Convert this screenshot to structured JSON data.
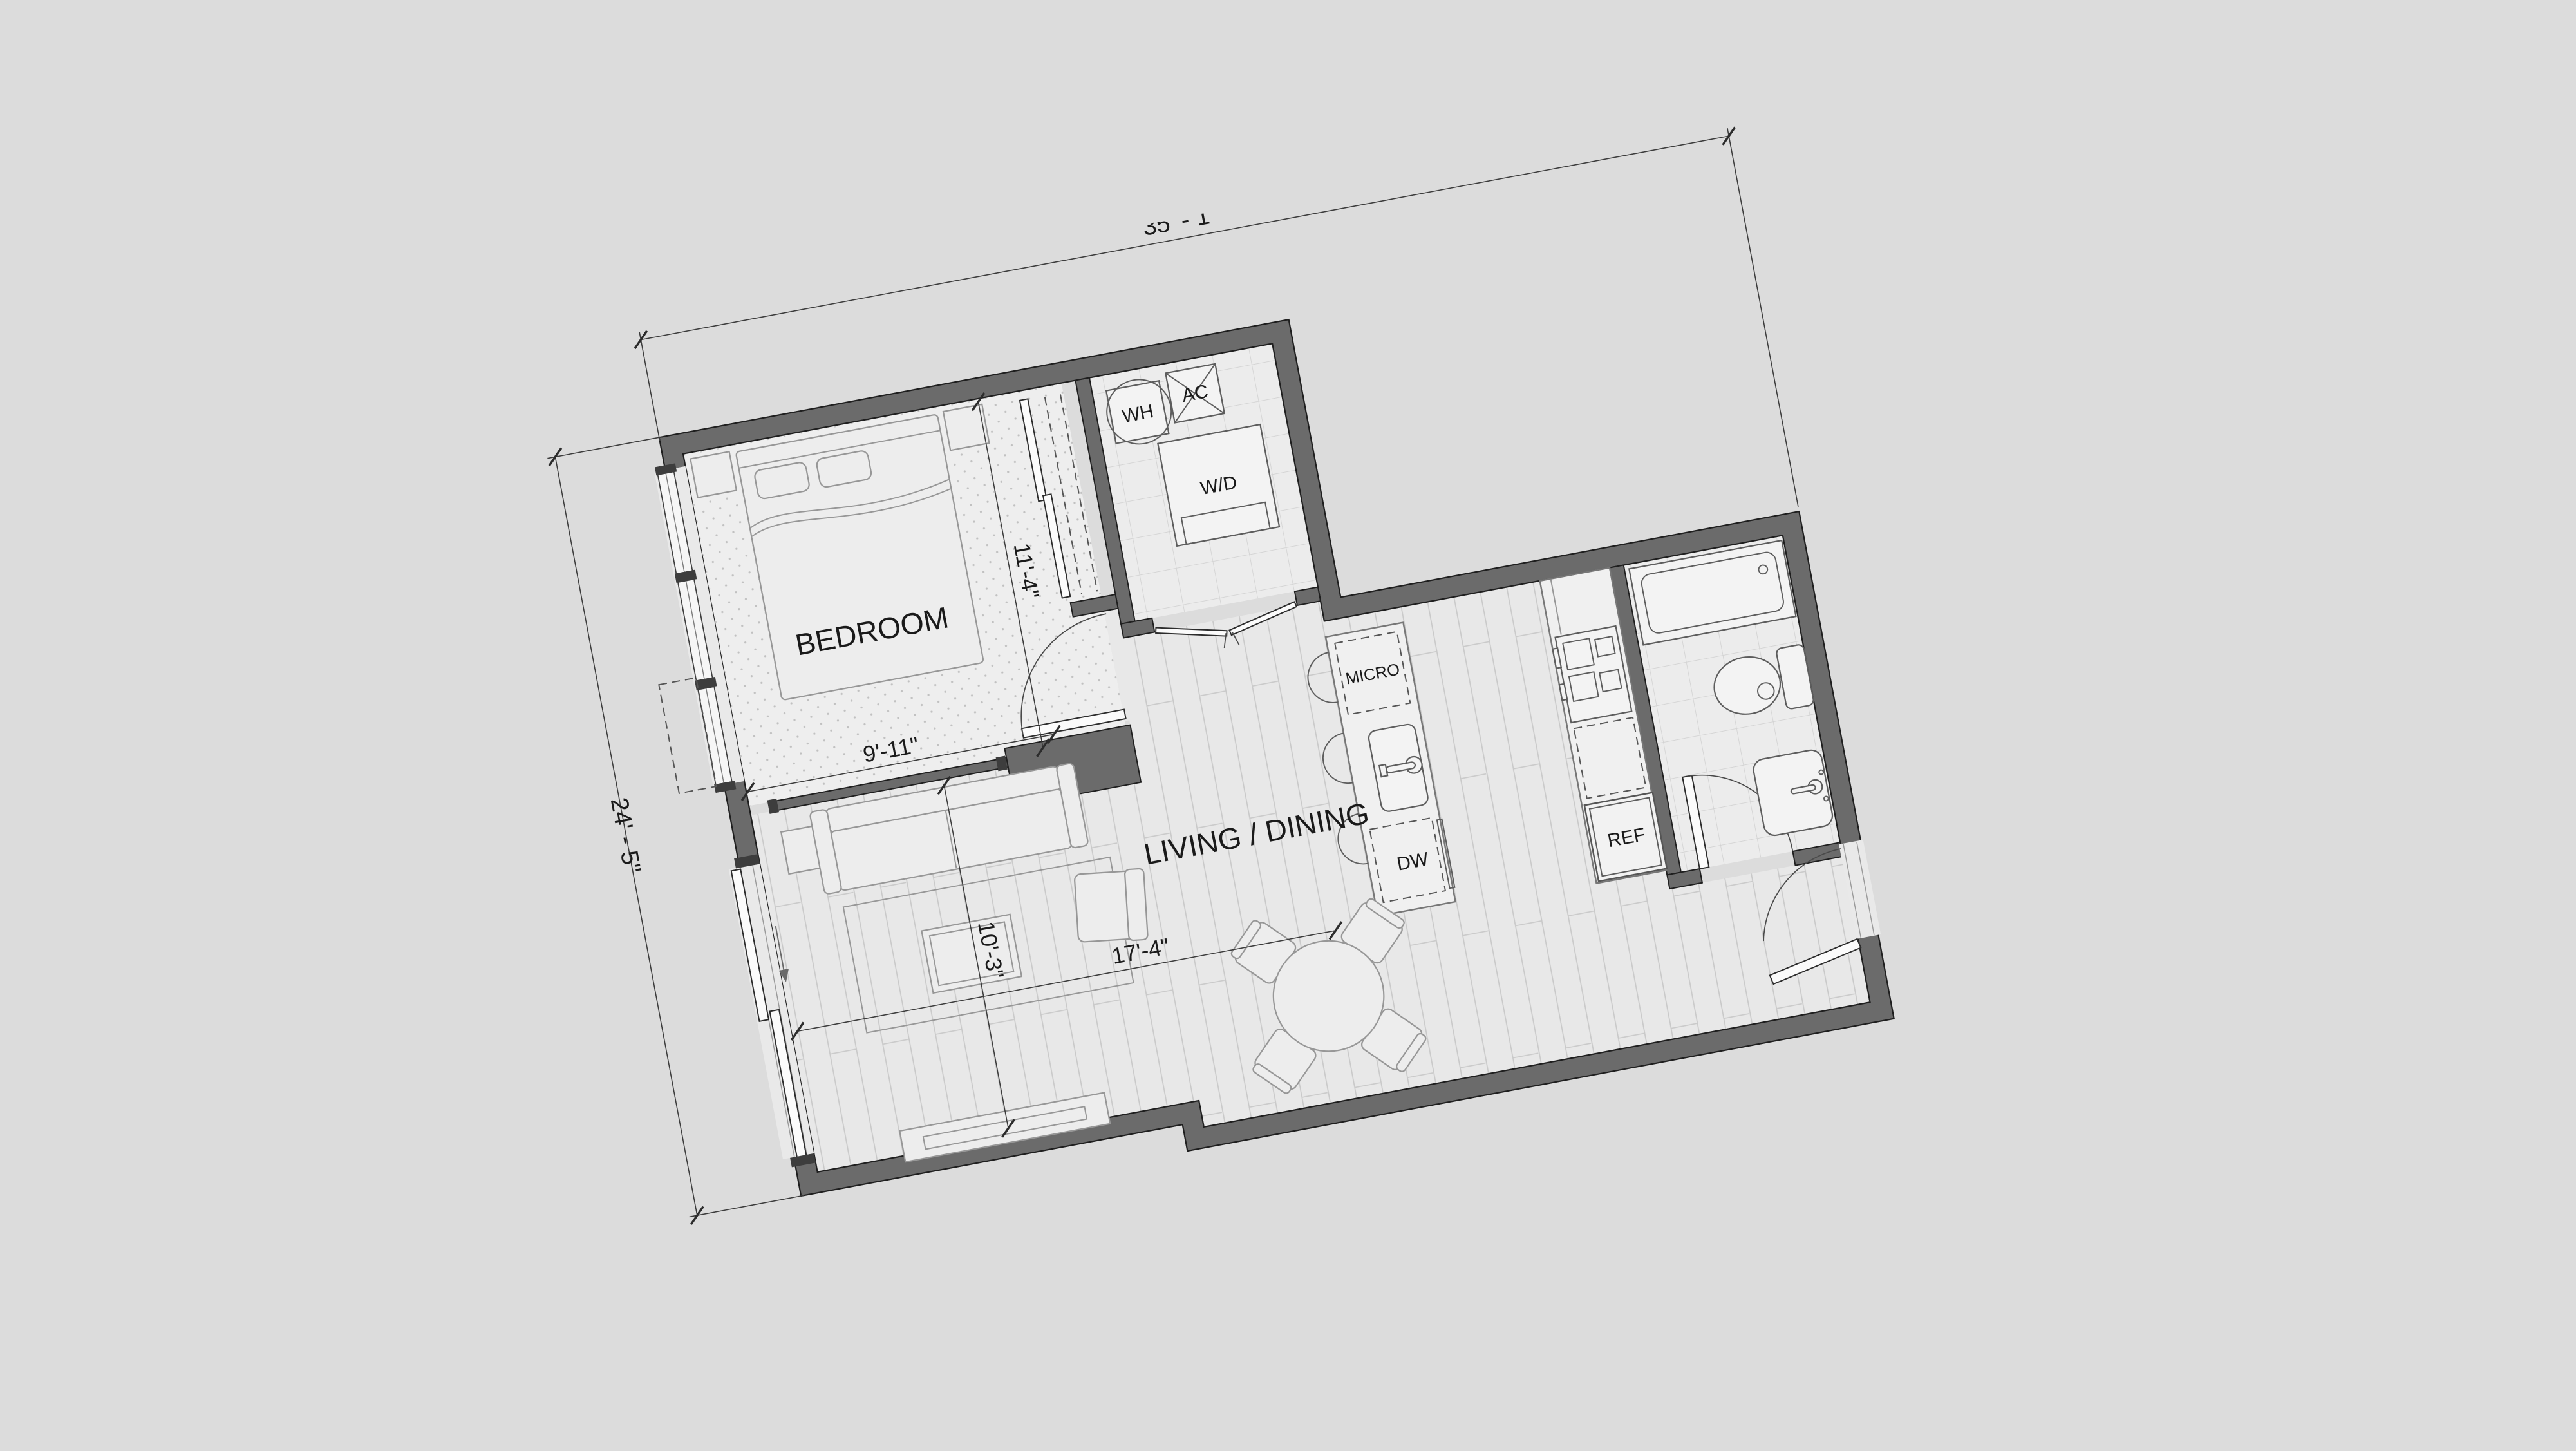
{
  "plan": {
    "type": "apartment-floor-plan",
    "background_color": "#dcdcdc",
    "wall_color": "#6b6b6b",
    "floor_color": "#e9e9e9",
    "rooms": {
      "bedroom": "BEDROOM",
      "living_dining": "LIVING / DINING"
    },
    "fixtures": {
      "water_heater": "WH",
      "air_conditioner": "AC",
      "washer_dryer": "W/D",
      "microwave": "MICRO",
      "dishwasher": "DW",
      "refrigerator": "REF"
    },
    "dimensions": {
      "overall_width": "35' - 1\"",
      "overall_height": "24' - 5\"",
      "bedroom_depth": "11'-4\"",
      "bedroom_width": "9'-11\"",
      "living_width": "10'-3\"",
      "living_length": "17'-4\""
    }
  }
}
